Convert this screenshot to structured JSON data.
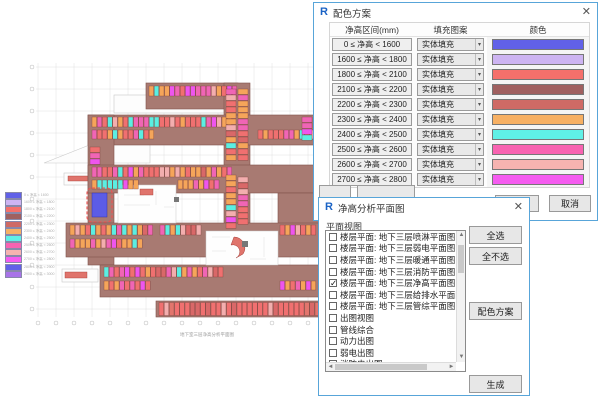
{
  "floor_plan": {
    "caption": "地下室三层净高分析平面图",
    "mass_color": "#a87a72",
    "mass_stroke": "#80524b",
    "highlight_color": "#f05050",
    "highlight_fill": "#5c5ce6",
    "stall_palette": [
      "#f5a55a",
      "#f5a55a",
      "#f5a55a",
      "#f5a55a",
      "#f5a55a",
      "#f07070",
      "#f07070",
      "#f07070",
      "#f07070",
      "#f065b5",
      "#f065b5",
      "#f065b5",
      "#ee55ee",
      "#f3aeae",
      "#f3aeae",
      "#5beee2",
      "#d96868"
    ],
    "stall_palette_bottom": [
      "#f07070",
      "#f07070",
      "#e2756d",
      "#f3aeae",
      "#f07070",
      "#d96868"
    ],
    "legend": {
      "items": [
        {
          "label": "0 ≤ 净高 < 1600",
          "color": "#6161e8"
        },
        {
          "label": "1600 ≤ 净高 < 1800",
          "color": "#cdb4f2"
        },
        {
          "label": "1800 ≤ 净高 < 2100",
          "color": "#f5706b"
        },
        {
          "label": "2100 ≤ 净高 < 2200",
          "color": "#a06060"
        },
        {
          "label": "2200 ≤ 净高 < 2300",
          "color": "#cf6a65"
        },
        {
          "label": "2300 ≤ 净高 < 2400",
          "color": "#f7b063"
        },
        {
          "label": "2400 ≤ 净高 < 2500",
          "color": "#5ff0e6"
        },
        {
          "label": "2500 ≤ 净高 < 2600",
          "color": "#f863b1"
        },
        {
          "label": "2600 ≤ 净高 < 2700",
          "color": "#f6b3b0"
        },
        {
          "label": "2700 ≤ 净高 < 2800",
          "color": "#f55cf0"
        },
        {
          "label": "2800 ≤ 净高 < 2900",
          "color": "#6161e8"
        },
        {
          "label": "2900 ≤ 净高 < 3000",
          "color": "#a873e8"
        }
      ]
    }
  },
  "color_scheme_dialog": {
    "title": "配色方案",
    "icon": "R",
    "close": "✕",
    "columns": [
      "净高区间(mm)",
      "填充图案",
      "颜色"
    ],
    "rows": [
      {
        "range": "0 ≤ 净高 < 1600",
        "pattern": "实体填充",
        "color": "#6161e8"
      },
      {
        "range": "1600 ≤ 净高 < 1800",
        "pattern": "实体填充",
        "color": "#cdb4f2"
      },
      {
        "range": "1800 ≤ 净高 < 2100",
        "pattern": "实体填充",
        "color": "#f5706b"
      },
      {
        "range": "2100 ≤ 净高 < 2200",
        "pattern": "实体填充",
        "color": "#a06060"
      },
      {
        "range": "2200 ≤ 净高 < 2300",
        "pattern": "实体填充",
        "color": "#cf6a65"
      },
      {
        "range": "2300 ≤ 净高 < 2400",
        "pattern": "实体填充",
        "color": "#f7b063"
      },
      {
        "range": "2400 ≤ 净高 < 2500",
        "pattern": "实体填充",
        "color": "#5ff0e6"
      },
      {
        "range": "2500 ≤ 净高 < 2600",
        "pattern": "实体填充",
        "color": "#f863b1"
      },
      {
        "range": "2600 ≤ 净高 < 2700",
        "pattern": "实体填充",
        "color": "#f6b3b0"
      },
      {
        "range": "2700 ≤ 净高 < 2800",
        "pattern": "实体填充",
        "color": "#f55cf0"
      }
    ],
    "ok_label": "确定",
    "cancel_label": "取消",
    "dropdown_arrow": "▾"
  },
  "plan_views_dialog": {
    "title": "净高分析平面图",
    "icon": "R",
    "close": "✕",
    "list_label": "平面视图",
    "items": [
      {
        "label": "楼层平面: 地下三层喷淋平面图",
        "checked": false
      },
      {
        "label": "楼层平面: 地下三层弱电平面图",
        "checked": false
      },
      {
        "label": "楼层平面: 地下三层暖通平面图",
        "checked": false
      },
      {
        "label": "楼层平面: 地下三层消防平面图",
        "checked": false
      },
      {
        "label": "楼层平面: 地下三层净高平面图",
        "checked": true
      },
      {
        "label": "楼层平面: 地下三层给排水平面图",
        "checked": false
      },
      {
        "label": "楼层平面: 地下三层管综平面图",
        "checked": false
      },
      {
        "label": "出图视图",
        "checked": false
      },
      {
        "label": "管线综合",
        "checked": false
      },
      {
        "label": "动力出图",
        "checked": false
      },
      {
        "label": "弱电出图",
        "checked": false
      },
      {
        "label": "消防电出图",
        "checked": false
      }
    ],
    "buttons": {
      "select_all": "全选",
      "select_none": "全不选",
      "color_scheme": "配色方案",
      "generate": "生成"
    },
    "check_glyph": "✓"
  }
}
